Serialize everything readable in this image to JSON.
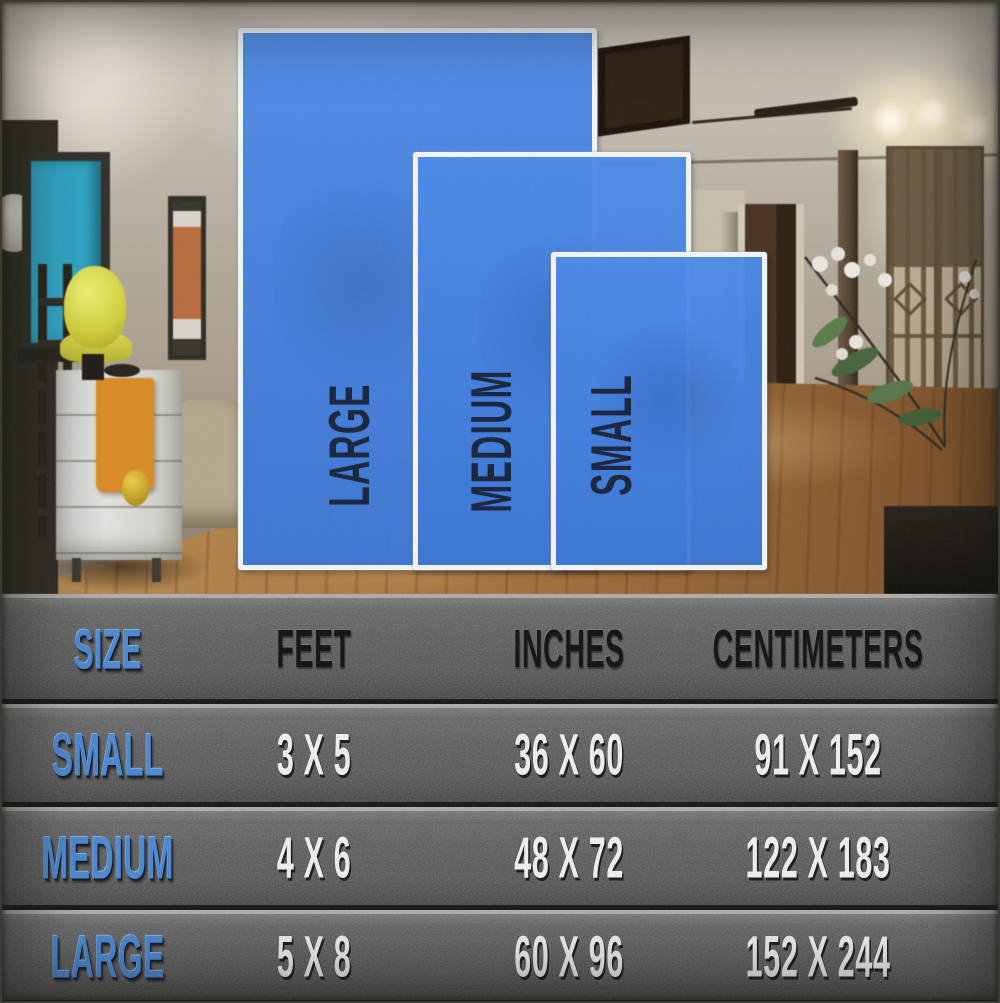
{
  "image_type": "rug size comparison infographic over room photo",
  "rug_overlay": {
    "sizes": [
      {
        "id": "large",
        "label": "LARGE"
      },
      {
        "id": "medium",
        "label": "MEDIUM"
      },
      {
        "id": "small",
        "label": "SMALL"
      }
    ],
    "rug_fill_color": "#3d7ce0",
    "rug_border_color": "#f3f7f9",
    "label_text_color": "#14213b"
  },
  "size_table": {
    "background_color": "#4c4c4c",
    "accent_text_color": "#4a86cf",
    "header_text_color": "#0f0f0f",
    "value_text_color": "#f0efed"
  },
  "chart_data": {
    "type": "table",
    "title": "Rug size chart",
    "columns": [
      "SIZE",
      "FEET",
      "INCHES",
      "CENTIMETERS"
    ],
    "rows": [
      {
        "size": "SMALL",
        "feet": "3 X 5",
        "inches": "36 X 60",
        "centimeters": "91 X 152"
      },
      {
        "size": "MEDIUM",
        "feet": "4 X 6",
        "inches": "48 X 72",
        "centimeters": "122 X 183"
      },
      {
        "size": "LARGE",
        "feet": "5 X 8",
        "inches": "60 X 96",
        "centimeters": "152 X 244"
      }
    ]
  }
}
